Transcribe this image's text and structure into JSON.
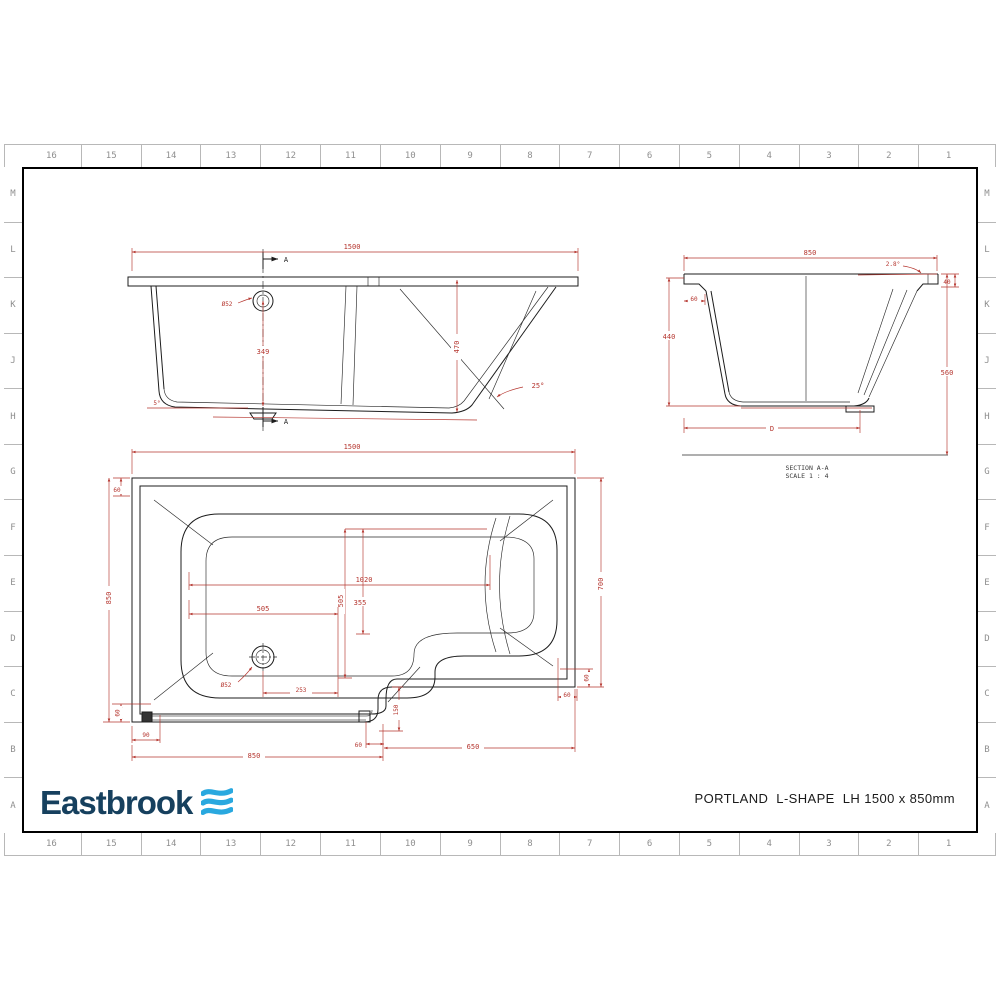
{
  "sheet": {
    "grid_columns": [
      "16",
      "15",
      "14",
      "13",
      "12",
      "11",
      "10",
      "9",
      "8",
      "7",
      "6",
      "5",
      "4",
      "3",
      "2",
      "1"
    ],
    "grid_rows": [
      "M",
      "L",
      "K",
      "J",
      "H",
      "G",
      "F",
      "E",
      "D",
      "C",
      "B",
      "A"
    ]
  },
  "brand": {
    "name": "Eastbrook"
  },
  "title_block": {
    "product_title": "PORTLAND  L-SHAPE  LH 1500 x 850mm"
  },
  "views": {
    "elevation": {
      "dims": {
        "overall_length": "1500",
        "section_marker": "A",
        "drain_diameter": "Ø52",
        "drain_height": "349",
        "depth": "470",
        "end_angle": "25°",
        "head_angle": "5°"
      }
    },
    "section": {
      "label_title": "SECTION A-A",
      "label_scale": "SCALE 1 : 4",
      "dims": {
        "overall_width": "850",
        "rim_angle": "2.8°",
        "rim_drop": "40",
        "rim_width": "60",
        "inner_depth": "440",
        "overall_height": "560",
        "base_width": "D"
      }
    },
    "plan": {
      "dims": {
        "overall_length": "1500",
        "rim_top": "60",
        "overall_width": "850",
        "inner_length": "1020",
        "seat_width": "355",
        "inner_width": "505",
        "drain_x": "505",
        "drain_diameter": "Ø52",
        "drain_offset": "253",
        "step_height": "150",
        "waste_drop": "60",
        "waste_length": "90",
        "shower_length": "850",
        "step_gap": "60",
        "bath_length": "650",
        "right_width": "700",
        "rim_right_v": "60",
        "rim_right_h": "60"
      }
    }
  },
  "colors": {
    "dimension_red": "#b5362f",
    "line_black": "#1c1c1c",
    "brand_navy": "#16405e",
    "brand_blue": "#29a8df"
  }
}
